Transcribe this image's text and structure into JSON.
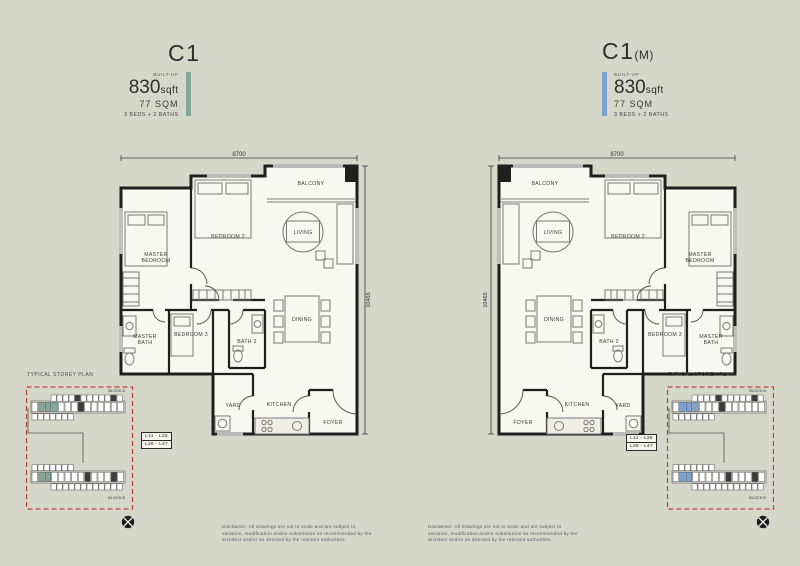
{
  "page": {
    "background": "#d5d8c9"
  },
  "units": [
    {
      "id": "c1",
      "title": "C1",
      "title_suffix": "",
      "builtup_label": "BUILT-UP",
      "area_value": "830",
      "area_unit": "sqft",
      "area_metric": "77 SQM",
      "layout": "3 BEDS + 2 BATHS",
      "accent": "#7fa79a",
      "levels": [
        "L11 - L25",
        "L26 - L47"
      ],
      "dim_width": "8700",
      "dim_depth": "10465"
    },
    {
      "id": "c1m",
      "title": "C1",
      "title_suffix": "(M)",
      "builtup_label": "BUILT-UP",
      "area_value": "830",
      "area_unit": "sqft",
      "area_metric": "77 SQM",
      "layout": "3 BEDS + 2 BATHS",
      "accent": "#7ba3d2",
      "levels": [
        "L11 - L25",
        "L26 - L47"
      ],
      "dim_width": "8700",
      "dim_depth": "10465"
    }
  ],
  "rooms": {
    "master_bedroom": [
      "MASTER",
      "BEDROOM"
    ],
    "bedroom2": [
      "BEDROOM 2"
    ],
    "balcony": [
      "BALCONY"
    ],
    "living": [
      "LIVING"
    ],
    "dining": [
      "DINING"
    ],
    "master_bath": [
      "MASTER",
      "BATH"
    ],
    "bedroom3": [
      "BEDROOM 3"
    ],
    "bath2": [
      "BATH 2"
    ],
    "yard": [
      "YARD"
    ],
    "kitchen": [
      "KITCHEN"
    ],
    "foyer": [
      "FOYER"
    ]
  },
  "storey_plan": {
    "title": "TYPICAL STOREY PLAN",
    "block_a": "BLOCK A",
    "block_b": "BLOCK B"
  },
  "disclaimer": "Disclaimer: All drawings are not to scale and are subject to variation, modification and/or substitution as recommended by the architect and/or as directed by the relevant authorities.",
  "watermark": [
    "K",
    "N",
    "L"
  ]
}
